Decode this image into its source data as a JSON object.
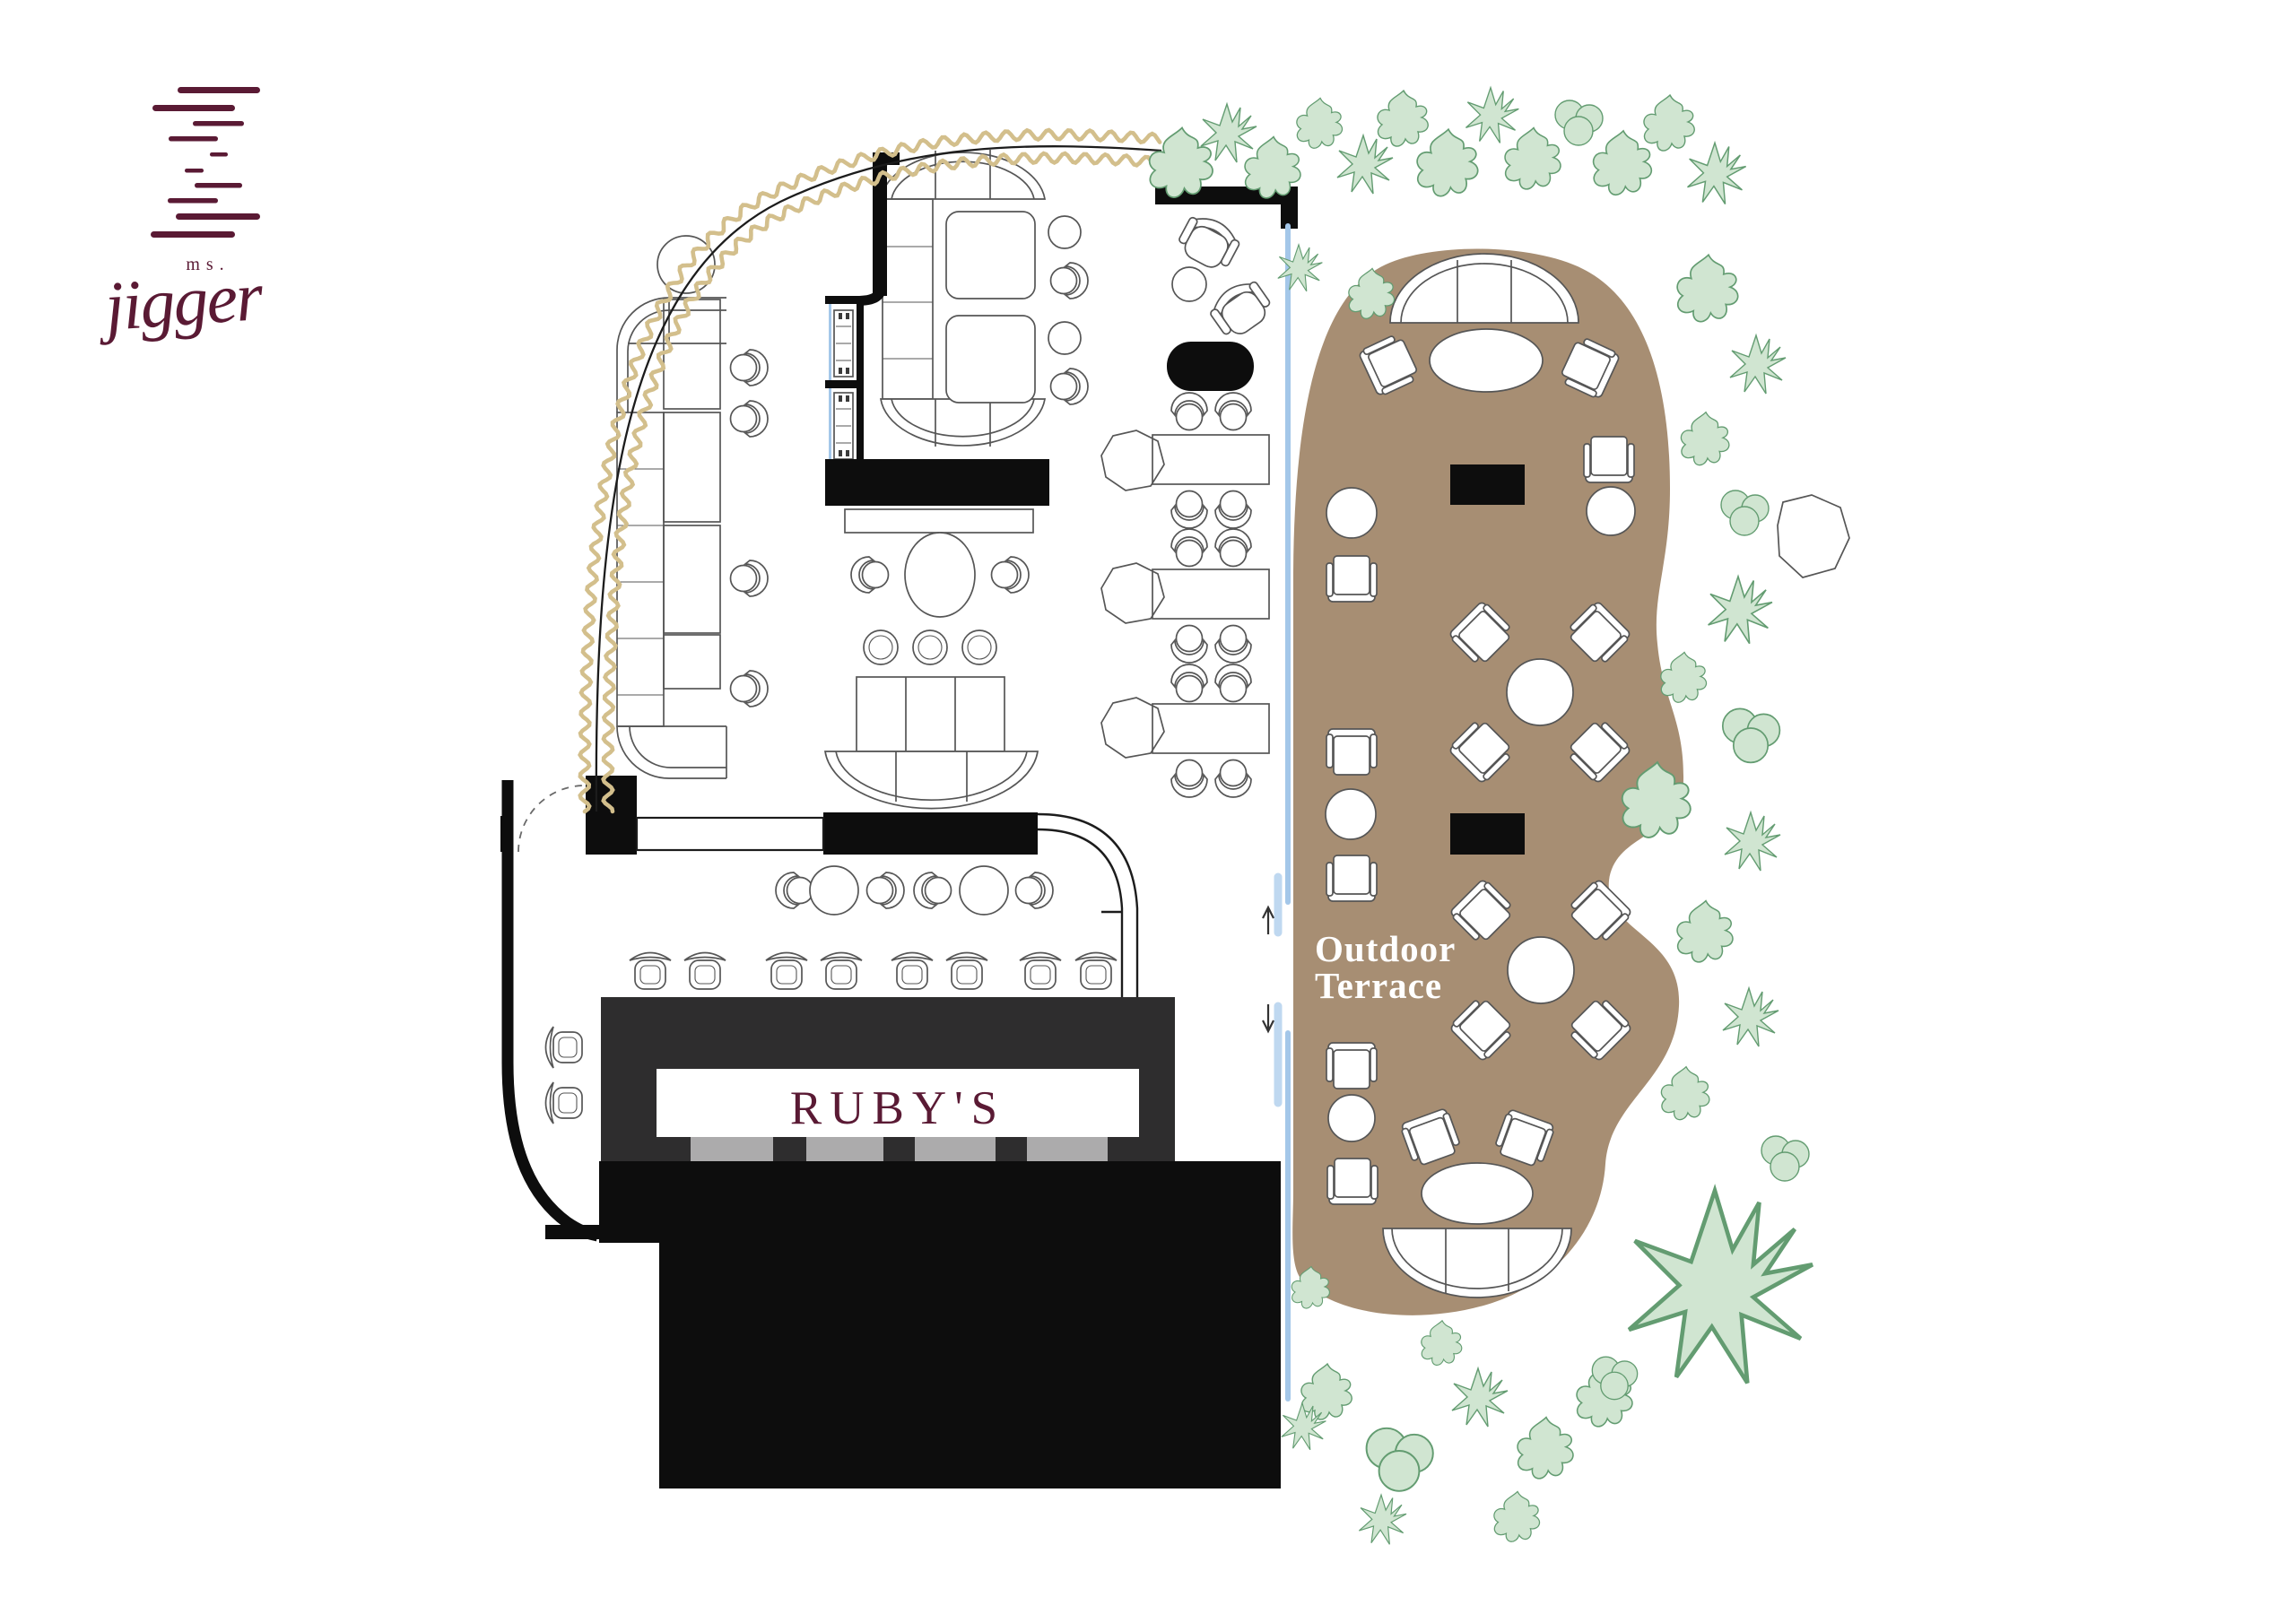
{
  "logo": {
    "ms_label": "ms.",
    "name": "jigger"
  },
  "bar": {
    "label": "RUBY'S"
  },
  "terrace": {
    "label_line1": "Outdoor",
    "label_line2": "Terrace"
  },
  "colors": {
    "maroon": "#5A1A34",
    "curtain": "#D3BF8C",
    "wall": "#0D0D0D",
    "terrace_floor": "#A78E73",
    "plant_fill": "#D0E5D1",
    "plant_stroke": "#639C71",
    "glass": "#A4C7E9",
    "glass_light": "#BFD8F0",
    "bar_body": "#2E2D2E",
    "bar_segment": "#ACABAC",
    "panel": "#FFFFFF"
  }
}
